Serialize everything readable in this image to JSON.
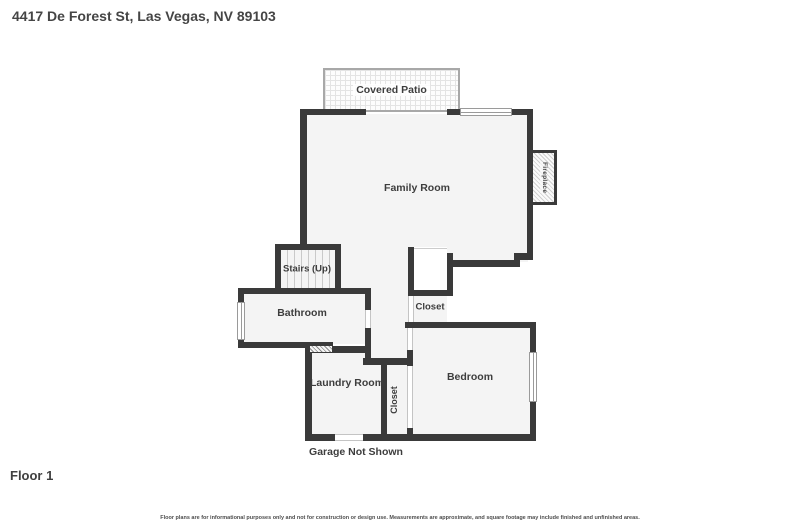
{
  "header": {
    "address": "4417 De Forest St, Las Vegas, NV 89103"
  },
  "floor": {
    "label": "Floor 1"
  },
  "rooms": {
    "covered_patio": "Covered Patio",
    "family_room": "Family Room",
    "fireplace": "Fireplace",
    "stairs": "Stairs (Up)",
    "bathroom": "Bathroom",
    "closet_hall": "Closet",
    "laundry": "Laundry Room",
    "closet_bedroom": "Closet",
    "bedroom": "Bedroom",
    "garage_note": "Garage Not Shown"
  },
  "disclaimer": "Floor plans are for informational purposes only and not for construction or design use. Measurements are approximate, and square footage may include finished and unfinished areas.",
  "colors": {
    "wall": "#3a3a3a",
    "floor_fill": "#f4f4f4",
    "label_text": "#3d3d3d",
    "background": "#ffffff"
  }
}
